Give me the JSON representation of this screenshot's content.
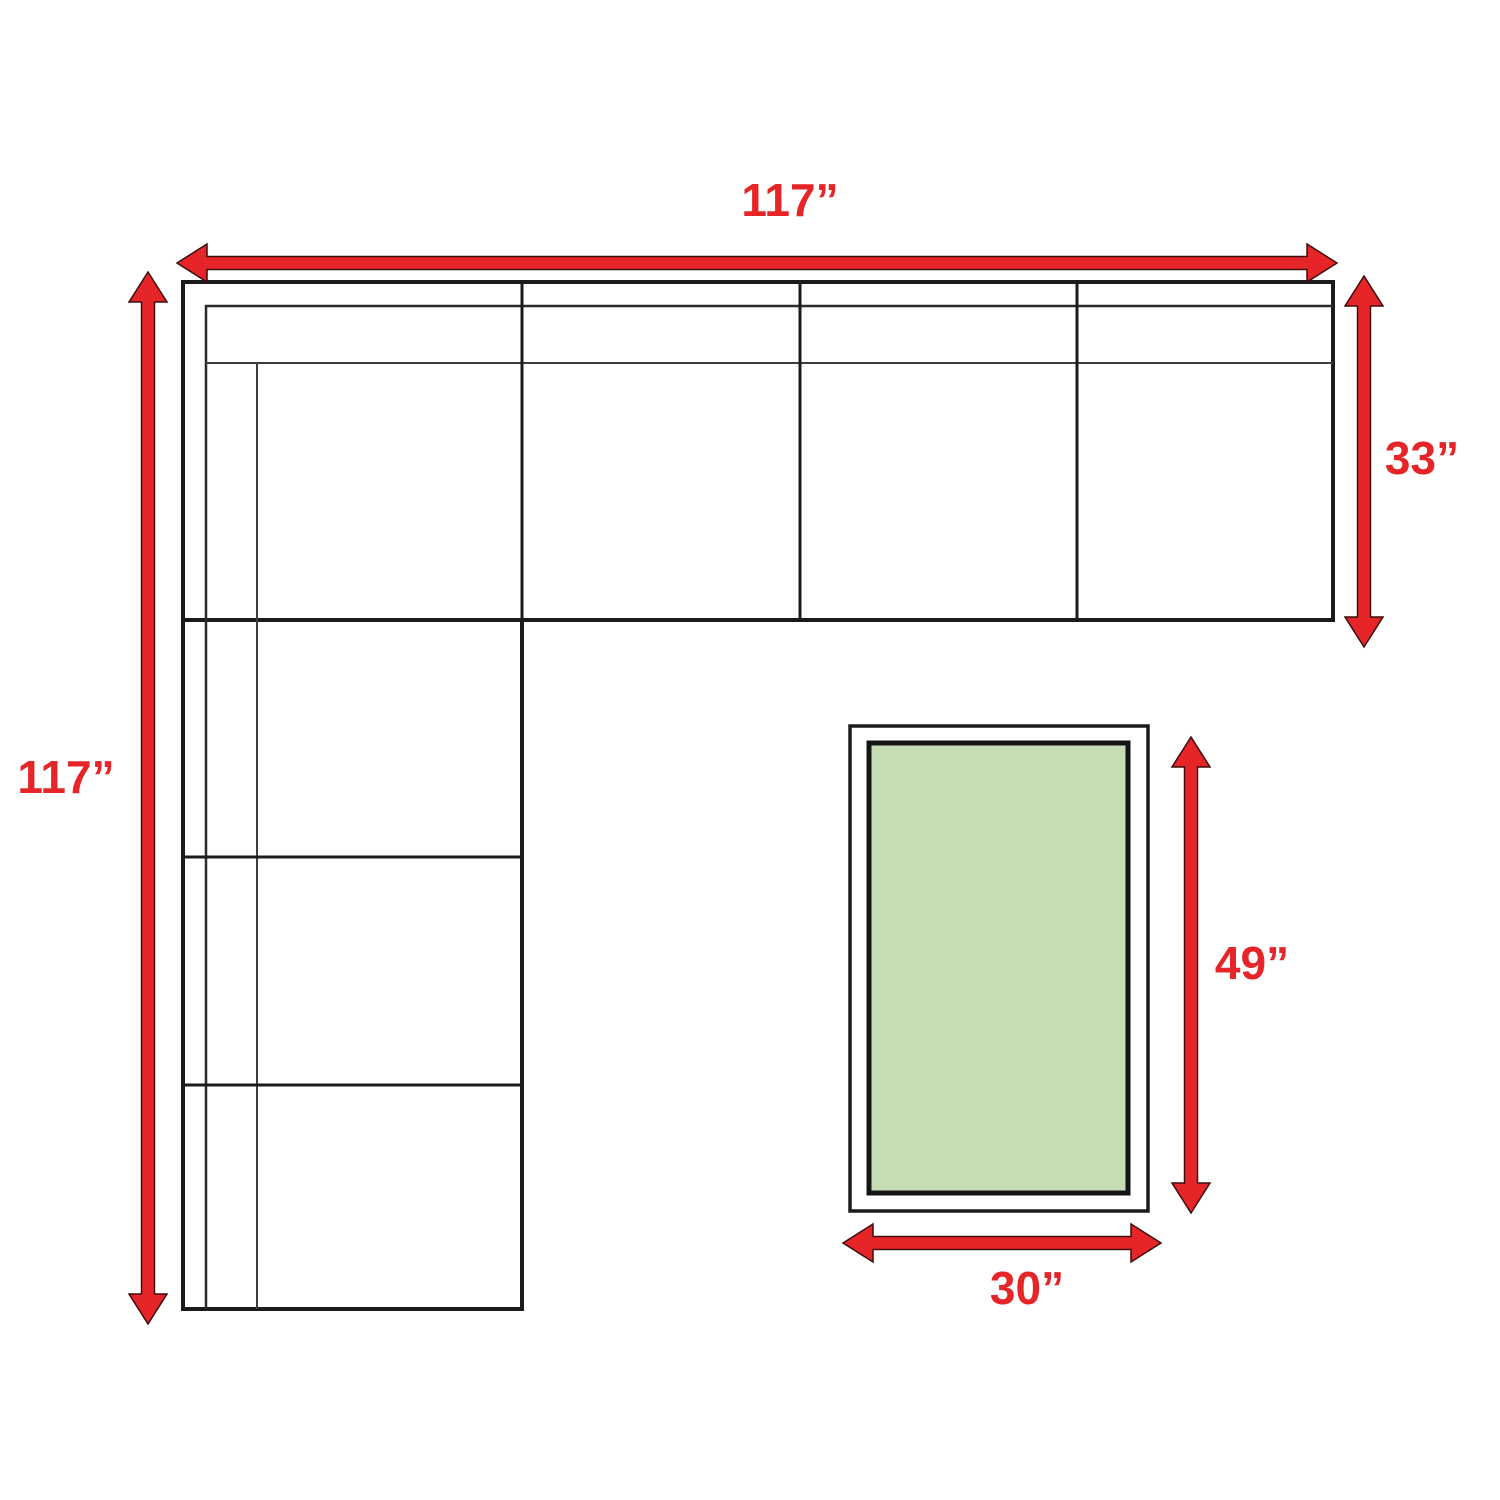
{
  "diagram": {
    "kind": "sectional sofa and coffee table dimension plan"
  },
  "labels": {
    "sofa_width": "117”",
    "sofa_depth_total": "117”",
    "section_depth": "33”",
    "table_length": "49”",
    "table_width": "30”"
  },
  "colors": {
    "arrow_red": "#e62529",
    "label_red": "#e62529",
    "table_green": "#c5deb5",
    "line_dark": "#1b1b1b",
    "background": "#ffffff"
  }
}
